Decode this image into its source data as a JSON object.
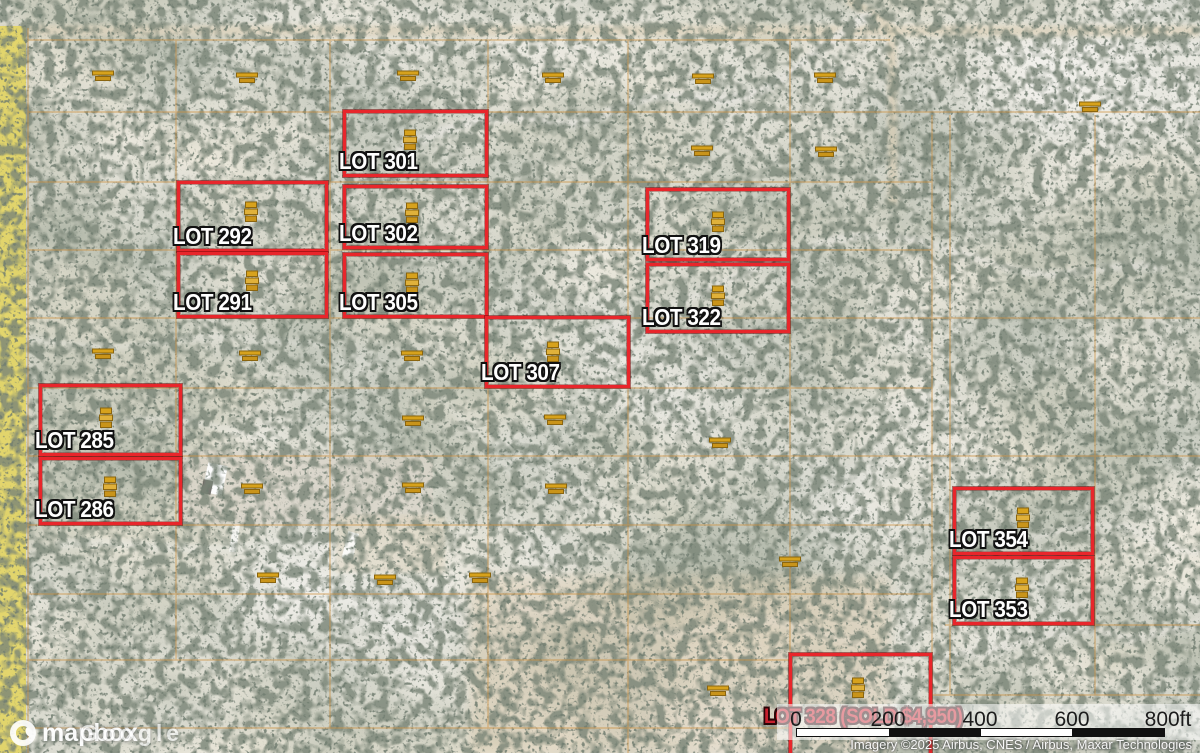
{
  "map": {
    "description": "Satellite imagery of desert land parcels with red for-sale lot outlines",
    "colors": {
      "lot_border": "#e8262b",
      "lot_label_text": "#ffffff",
      "sold_label_text": "#c8202e",
      "parcel_grid": "#cd8f3f",
      "marker_gold": "#d7a21c",
      "road_highlight_yellow": "#e2d45f"
    }
  },
  "lots": [
    {
      "id": "301",
      "label": "LOT 301",
      "x": 343,
      "y": 110,
      "w": 145,
      "h": 67,
      "sold": false
    },
    {
      "id": "292",
      "label": "LOT 292",
      "x": 177,
      "y": 181,
      "w": 151,
      "h": 71,
      "sold": false
    },
    {
      "id": "302",
      "label": "LOT 302",
      "x": 343,
      "y": 185,
      "w": 145,
      "h": 64,
      "sold": false
    },
    {
      "id": "291",
      "label": "LOT 291",
      "x": 177,
      "y": 252,
      "w": 151,
      "h": 66,
      "sold": false
    },
    {
      "id": "305",
      "label": "LOT 305",
      "x": 343,
      "y": 253,
      "w": 145,
      "h": 65,
      "sold": false
    },
    {
      "id": "319",
      "label": "LOT 319",
      "x": 646,
      "y": 188,
      "w": 144,
      "h": 73,
      "sold": false
    },
    {
      "id": "322",
      "label": "LOT 322",
      "x": 646,
      "y": 263,
      "w": 144,
      "h": 70,
      "sold": false
    },
    {
      "id": "307",
      "label": "LOT 307",
      "x": 485,
      "y": 316,
      "w": 145,
      "h": 72,
      "sold": false
    },
    {
      "id": "285",
      "label": "LOT 285",
      "x": 39,
      "y": 384,
      "w": 143,
      "h": 72,
      "sold": false
    },
    {
      "id": "286",
      "label": "LOT 286",
      "x": 39,
      "y": 457,
      "w": 143,
      "h": 68,
      "sold": false
    },
    {
      "id": "354",
      "label": "LOT 354",
      "x": 953,
      "y": 487,
      "w": 141,
      "h": 68,
      "sold": false
    },
    {
      "id": "353",
      "label": "LOT 353",
      "x": 953,
      "y": 556,
      "w": 141,
      "h": 69,
      "sold": false
    },
    {
      "id": "328",
      "label": "LOT 328 (SOLD $4,950)",
      "x": 789,
      "y": 653,
      "w": 143,
      "h": 105,
      "sold": true
    }
  ],
  "markers": {
    "lot_markers": [
      {
        "x": 410,
        "y": 140
      },
      {
        "x": 251,
        "y": 212
      },
      {
        "x": 412,
        "y": 213
      },
      {
        "x": 252,
        "y": 281
      },
      {
        "x": 412,
        "y": 283
      },
      {
        "x": 718,
        "y": 222
      },
      {
        "x": 718,
        "y": 296
      },
      {
        "x": 553,
        "y": 352
      },
      {
        "x": 106,
        "y": 418
      },
      {
        "x": 110,
        "y": 487
      },
      {
        "x": 1023,
        "y": 518
      },
      {
        "x": 1022,
        "y": 588
      },
      {
        "x": 858,
        "y": 688
      }
    ],
    "field_markers": [
      {
        "x": 103,
        "y": 75
      },
      {
        "x": 247,
        "y": 77
      },
      {
        "x": 408,
        "y": 75
      },
      {
        "x": 553,
        "y": 77
      },
      {
        "x": 703,
        "y": 78
      },
      {
        "x": 825,
        "y": 77
      },
      {
        "x": 1090,
        "y": 106
      },
      {
        "x": 702,
        "y": 150
      },
      {
        "x": 826,
        "y": 151
      },
      {
        "x": 103,
        "y": 353
      },
      {
        "x": 250,
        "y": 355
      },
      {
        "x": 412,
        "y": 355
      },
      {
        "x": 413,
        "y": 420
      },
      {
        "x": 555,
        "y": 419
      },
      {
        "x": 720,
        "y": 442
      },
      {
        "x": 413,
        "y": 487
      },
      {
        "x": 556,
        "y": 488
      },
      {
        "x": 252,
        "y": 488
      },
      {
        "x": 268,
        "y": 577
      },
      {
        "x": 385,
        "y": 579
      },
      {
        "x": 480,
        "y": 577
      },
      {
        "x": 790,
        "y": 561
      },
      {
        "x": 718,
        "y": 690
      }
    ]
  },
  "scalebar": {
    "labels": [
      "0",
      "200",
      "400",
      "600",
      "800ft"
    ],
    "segments": [
      "white",
      "black",
      "white",
      "black"
    ]
  },
  "attribution": "Imagery ©2025 Airbus, CNES / Airbus, Maxar Technologies",
  "logos": {
    "map_provider": "mapbox",
    "imagery_provider": "Google"
  }
}
